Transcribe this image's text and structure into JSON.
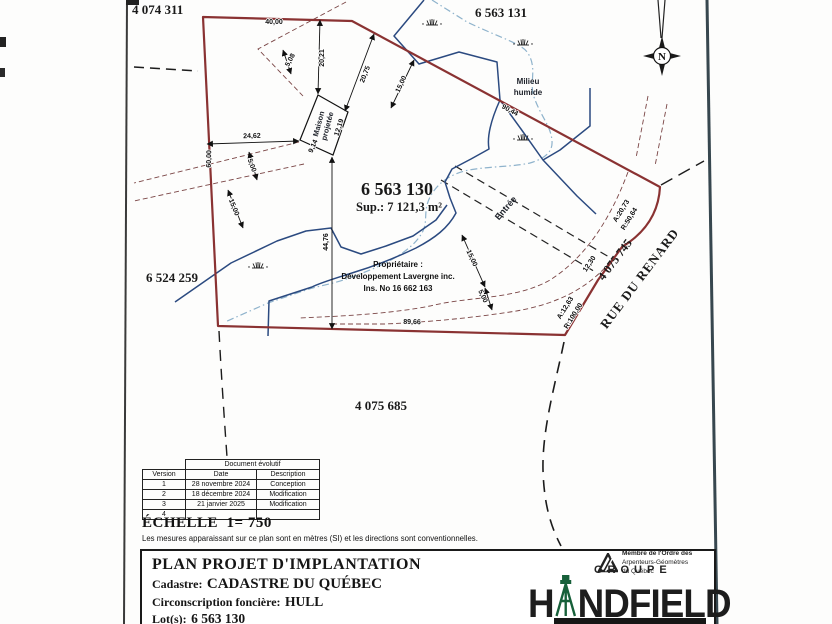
{
  "colors": {
    "boundary_red": "#8a3232",
    "setback_dash": "#7a4545",
    "stream_blue": "#2b4a80",
    "wetland_dash_blue": "#8fb3cc",
    "logo_green": "#17603a",
    "ink": "#141414"
  },
  "plan": {
    "lots": {
      "top_left": "4 074 311",
      "top_right": "6 563 131",
      "main": "6 563 130",
      "main_area": "Sup.: 7 121,3 m²",
      "left": "6 524 259",
      "bottom": "4 075 685",
      "road_lot": "4 075 745",
      "road_name": "RUE DU RENARD"
    },
    "owner": {
      "line1": "Propriétaire :",
      "line2": "Développement Lavergne inc.",
      "line3": "Ins. No 16 662 163"
    },
    "labels": {
      "wetland_1": "Milieu",
      "wetland_2": "humide",
      "house_1": "Maison",
      "house_2": "projetée",
      "entrance": "Entrée"
    },
    "north_letter": "N",
    "measurements": [
      "40,00",
      "20,21",
      "5,08",
      "20,75",
      "15,00",
      "90,44",
      "24,62",
      "60,00",
      "12,19",
      "9,14",
      "44,76",
      "15,00",
      "5,00",
      "5,00",
      "15,00",
      "89,66",
      "12,30",
      "A:20,73",
      "R:50,64",
      "A:12,63",
      "R:100,00"
    ]
  },
  "table": {
    "title": "Document évolutif",
    "headers": [
      "Version",
      "Date",
      "Description"
    ],
    "rows": [
      {
        "version": "1",
        "date": "28 novembre 2024",
        "description": "Conception"
      },
      {
        "version": "2",
        "date": "18 décembre 2024",
        "description": "Modification"
      },
      {
        "version": "3",
        "date": "21 janvier 2025",
        "description": "Modification"
      },
      {
        "version": "4",
        "date": "",
        "description": ""
      }
    ]
  },
  "scale_block": {
    "echelle": "ÉCHELLE  1= 750",
    "note": "Les mesures apparaissant sur ce plan sont en mètres (SI) et les directions sont conventionnelles."
  },
  "title_block": {
    "title": "PLAN PROJET D'IMPLANTATION",
    "cadastre_label": "Cadastre:",
    "cadastre_value": "CADASTRE DU QUÉBEC",
    "circonscription_label": "Circonscription foncière:",
    "circonscription_value": "HULL",
    "lots_label": "Lot(s):",
    "lots_value": "6 563 130"
  },
  "logo": {
    "membre_line1": "Membre de l'Ordre des",
    "membre_line2": "Arpenteurs-Géomètres",
    "membre_line3": "du Québec",
    "groupe": "GROUPE",
    "name_first": "H",
    "name_rest": "NDFIELD"
  }
}
